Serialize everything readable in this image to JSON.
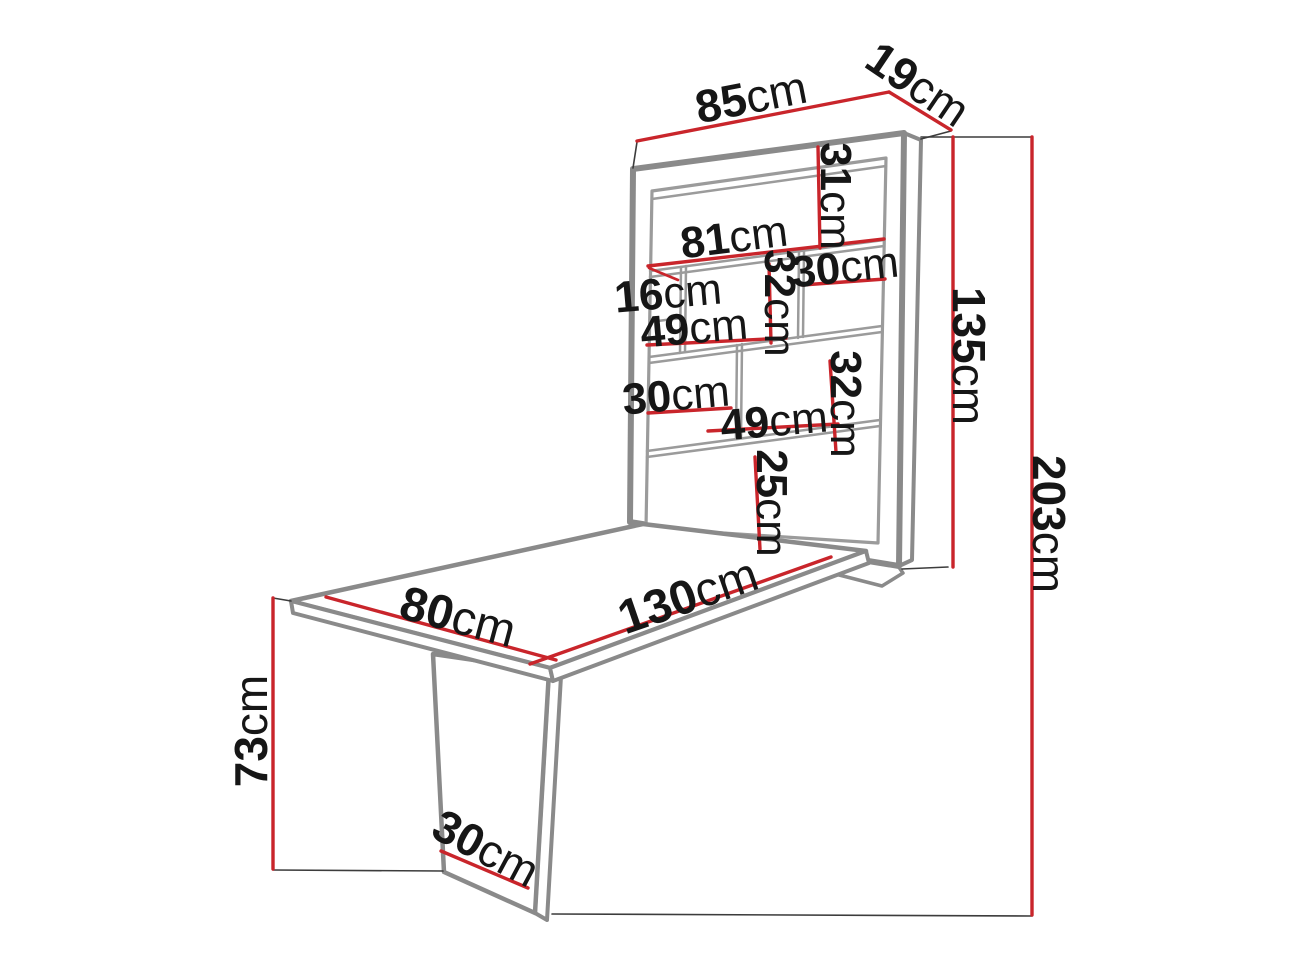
{
  "diagram": {
    "kind": "furniture-dimension-diagram",
    "subject": "wall-mounted fold-out desk with shelving unit",
    "unit": "cm"
  },
  "colors": {
    "dimension": "#c9252b",
    "furniture_edge": "#8a8a8a",
    "furniture_detail": "#9b9b9b",
    "extension_line": "#3c3c3c",
    "text": "#161616",
    "background": "#ffffff"
  },
  "dims": {
    "top_width": {
      "v": "85",
      "u": "cm"
    },
    "depth": {
      "v": "19",
      "u": "cm"
    },
    "top_shelf_height": {
      "v": "31",
      "u": "cm"
    },
    "interior_width": {
      "v": "81",
      "u": "cm"
    },
    "small_cubby": {
      "v": "16",
      "u": "cm"
    },
    "row2_height": {
      "v": "32",
      "u": "cm"
    },
    "row2_right_width": {
      "v": "30",
      "u": "cm"
    },
    "row2_width": {
      "v": "49",
      "u": "cm"
    },
    "row3_left_width": {
      "v": "30",
      "u": "cm"
    },
    "row3_width": {
      "v": "49",
      "u": "cm"
    },
    "row3_height": {
      "v": "32",
      "u": "cm"
    },
    "bottom_shelf_height": {
      "v": "25",
      "u": "cm"
    },
    "cabinet_height": {
      "v": "135",
      "u": "cm"
    },
    "total_height": {
      "v": "203",
      "u": "cm"
    },
    "table_length": {
      "v": "130",
      "u": "cm"
    },
    "table_width": {
      "v": "80",
      "u": "cm"
    },
    "table_height": {
      "v": "73",
      "u": "cm"
    },
    "leg_width": {
      "v": "30",
      "u": "cm"
    }
  }
}
